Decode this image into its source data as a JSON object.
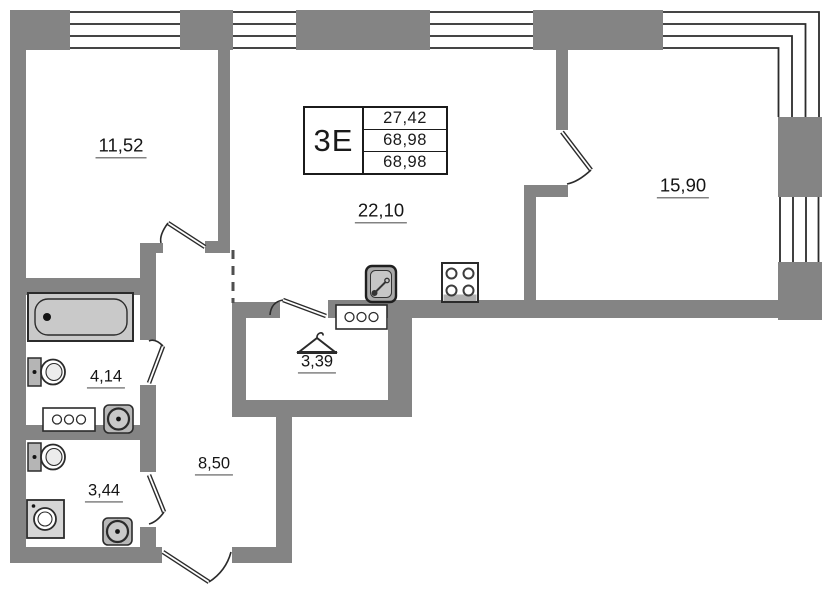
{
  "plan": {
    "title": "apartment-floor-plan",
    "unit": {
      "type_label": "3Е",
      "stats": [
        "27,42",
        "68,98",
        "68,98"
      ]
    },
    "rooms": [
      {
        "name": "bedroom-1",
        "area": "11,52"
      },
      {
        "name": "living-room",
        "area": "22,10"
      },
      {
        "name": "bedroom-2",
        "area": "15,90"
      },
      {
        "name": "bathroom",
        "area": "4,14"
      },
      {
        "name": "dressing-room",
        "area": "3,39"
      },
      {
        "name": "hallway",
        "area": "8,50"
      },
      {
        "name": "wc",
        "area": "3,44"
      }
    ],
    "fixtures": [
      "bathtub",
      "toilet",
      "toilet",
      "washbasin",
      "washbasin",
      "washing-machine",
      "radiator",
      "radiator",
      "kitchen-sink",
      "stove",
      "clothes-hanger"
    ],
    "colors": {
      "wall": "#848484",
      "line": "#2b2b2b",
      "fixture_fill": "#c9c9c9",
      "background": "#ffffff"
    }
  }
}
